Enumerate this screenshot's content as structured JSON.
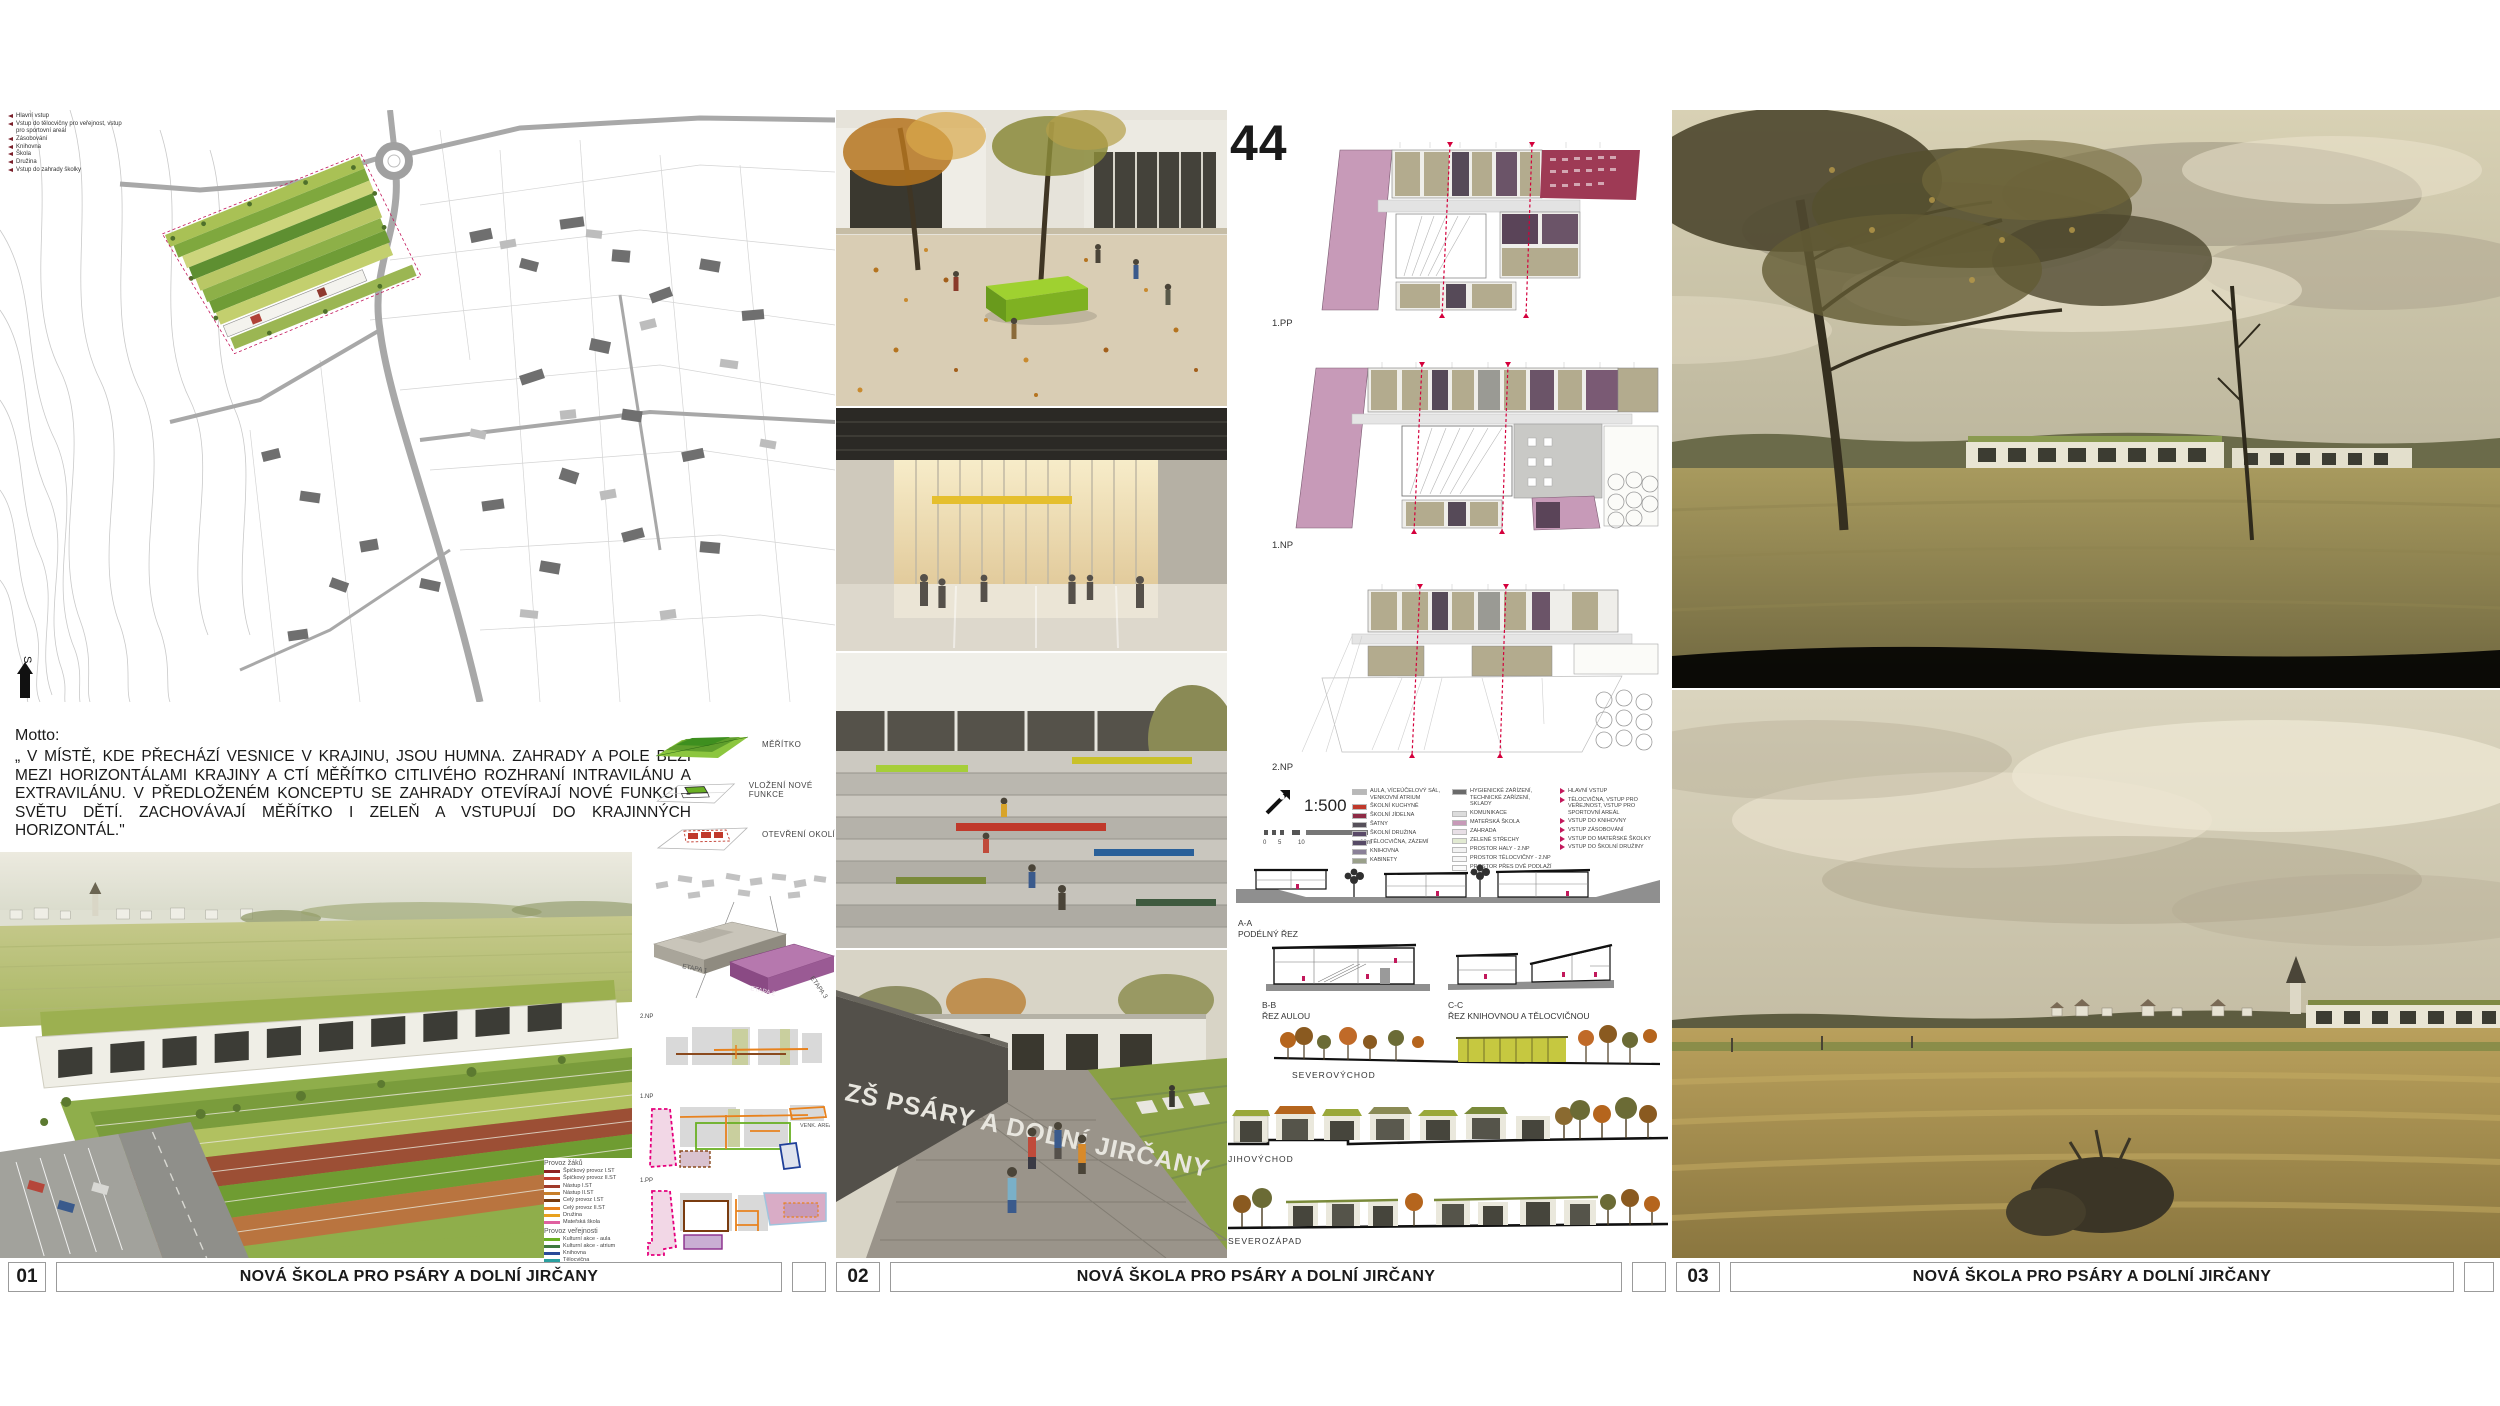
{
  "board": {
    "footer": {
      "panels": [
        {
          "number": "01",
          "title": "NOVÁ ŠKOLA PRO PSÁRY A DOLNÍ JIRČANY"
        },
        {
          "number": "02",
          "title": "NOVÁ ŠKOLA PRO PSÁRY A DOLNÍ JIRČANY"
        },
        {
          "number": "03",
          "title": "NOVÁ ŠKOLA PRO PSÁRY A DOLNÍ JIRČANY"
        }
      ]
    }
  },
  "panel01": {
    "site_plan": {
      "north_label": "S",
      "legend": [
        {
          "label": "Hlavní vstup"
        },
        {
          "label": "Vstup do tělocvičny pro veřejnost, vstup pro sportovní areál"
        },
        {
          "label": "Zásobování"
        },
        {
          "label": "Knihovna"
        },
        {
          "label": "Škola"
        },
        {
          "label": "Družina"
        },
        {
          "label": "Vstup do zahrady školky"
        }
      ]
    },
    "motto": {
      "heading": "Motto:",
      "text": "„ V MÍSTĚ, KDE PŘECHÁZÍ VESNICE V KRAJINU, JSOU HUMNA. ZAHRADY A POLE BĚŽÍ MEZI HORIZONTÁLAMI KRAJINY A CTÍ MĚŘÍTKO CITLIVÉHO ROZHRANÍ INTRAVILÁNU A EXTRAVILÁNU. V PŘEDLOŽENÉM KONCEPTU SE ZAHRADY OTEVÍRAJÍ NOVÉ FUNKCI - SVĚTU DĚTÍ. ZACHOVÁVAJÍ MĚŘÍTKO I ZELEŇ A VSTUPUJÍ DO KRAJINNÝCH HORIZONTÁL.\""
    },
    "concept_diagrams": [
      {
        "label": "MĚŘÍTKO"
      },
      {
        "label": "VLOŽENÍ NOVÉ FUNKCE"
      },
      {
        "label": "OTEVŘENÍ OKOLÍ"
      }
    ],
    "phasing_axon": {
      "labels": [
        "ETAPA 1",
        "ETAPA 2",
        "ETAPA 3"
      ]
    },
    "scheme_plans": {
      "top_label": "2.NP",
      "middle_label": "1.NP",
      "bottom_label": "1.PP",
      "annotation": "VENK. AREÁL"
    },
    "flow_legend": {
      "groups": [
        {
          "title": "Provoz žáků",
          "items": [
            {
              "label": "Špičkový provoz I.ST",
              "color": "#8e2222"
            },
            {
              "label": "Špičkový provoz II.ST",
              "color": "#c0392b"
            },
            {
              "label": "Nástup I.ST",
              "color": "#a03a2a"
            },
            {
              "label": "Nástup II.ST",
              "color": "#c77f2a"
            },
            {
              "label": "Celý provoz I.ST",
              "color": "#7a3c10"
            },
            {
              "label": "Celý provoz II.ST",
              "color": "#e8821e"
            },
            {
              "label": "Družina",
              "color": "#e8a11e"
            },
            {
              "label": "Mateřská škola",
              "color": "#e060a0"
            }
          ]
        },
        {
          "title": "Provoz veřejnosti",
          "items": [
            {
              "label": "Kulturní akce - aula",
              "color": "#6ab023"
            },
            {
              "label": "Kulturní akce - atrium",
              "color": "#3f7a3f"
            },
            {
              "label": "Knihovna",
              "color": "#2a4a99"
            },
            {
              "label": "Tělocvična",
              "color": "#2aa0a0"
            },
            {
              "label": "Návaznost pěšiny na tělocvičnu",
              "color": "#9fd8d8"
            }
          ]
        }
      ]
    }
  },
  "panel02": {
    "sheet_number": "44",
    "floor_plans": {
      "top_label": "1.PP",
      "middle_label": "1.NP",
      "bottom_label": "2.NP"
    },
    "scale": {
      "text": "1:500",
      "ticks": [
        "0",
        "5",
        "10",
        "20m"
      ]
    },
    "plan_legend": {
      "columns": [
        {
          "items": [
            {
              "label": "AULA, VÍCEÚČELOVÝ SÁL, VENKOVNÍ ATRIUM",
              "color": "#b8b8b8"
            },
            {
              "label": "ŠKOLNÍ KUCHYNĚ",
              "color": "#c0392b"
            },
            {
              "label": "ŠKOLNÍ JÍDELNA",
              "color": "#8e2a45"
            },
            {
              "label": "ŠATNY",
              "color": "#56505a"
            },
            {
              "label": "ŠKOLNÍ DRUŽINA",
              "color": "#5a4a68"
            },
            {
              "label": "TĚLOCVIČNA, ZÁZEMÍ",
              "color": "#564a66"
            },
            {
              "label": "KNIHOVNA",
              "color": "#8a8098"
            },
            {
              "label": "KABINETY",
              "color": "#9aa08a"
            }
          ]
        },
        {
          "items": [
            {
              "label": "HYGIENICKÉ ZAŘÍZENÍ, TECHNICKÉ ZAŘÍZENÍ, SKLADY",
              "color": "#6a6a6a"
            },
            {
              "label": "KOMUNIKACE",
              "color": "#dcdcdc"
            },
            {
              "label": "MATEŘSKÁ ŠKOLA",
              "color": "#c79ab8"
            },
            {
              "label": "ZAHRADA",
              "color": "#e8dfe6"
            },
            {
              "label": "ZELENÉ STŘECHY",
              "color": "#e2ead2"
            },
            {
              "label": "PROSTOR HALY - 2.NP",
              "color": "#f2f2f2"
            },
            {
              "label": "PROSTOR TĚLOCVIČNY - 2.NP",
              "color": "#f7f7f7"
            },
            {
              "label": "PROSTOR PŘES DVĚ PODLAŽÍ - 2.NP",
              "color": "#fbfbfb"
            }
          ]
        },
        {
          "items": [
            {
              "label": "HLAVNÍ VSTUP"
            },
            {
              "label": "TĚLOCVIČNA, VSTUP PRO VEŘEJNOST, VSTUP PRO SPORTOVNÍ AREÁL"
            },
            {
              "label": "VSTUP DO KNIHOVNY"
            },
            {
              "label": "VSTUP ZÁSOBOVÁNÍ"
            },
            {
              "label": "VSTUP DO MATEŘSKÉ ŠKOLKY"
            },
            {
              "label": "VSTUP DO ŠKOLNÍ DRUŽINY"
            }
          ]
        }
      ]
    },
    "sections": [
      {
        "code": "A-A",
        "name": "PODÉLNÝ ŘEZ"
      },
      {
        "code": "B-B",
        "name": "ŘEZ AULOU"
      },
      {
        "code": "C-C",
        "name": "ŘEZ KNIHOVNOU A TĚLOCVIČNOU"
      }
    ],
    "elevations": [
      {
        "label": "SEVEROVÝCHOD"
      },
      {
        "label": "JIHOVÝCHOD"
      },
      {
        "label": "SEVEROZÁPAD"
      }
    ],
    "wall_sign": "ZŠ PSÁRY A DOLNÍ JIRČANY"
  },
  "colors": {
    "accent_red": "#d4003c",
    "plan_pink": "#c79ab8",
    "plan_purple": "#5a4458",
    "lime": "#8dc63f",
    "orange": "#e8821e"
  }
}
